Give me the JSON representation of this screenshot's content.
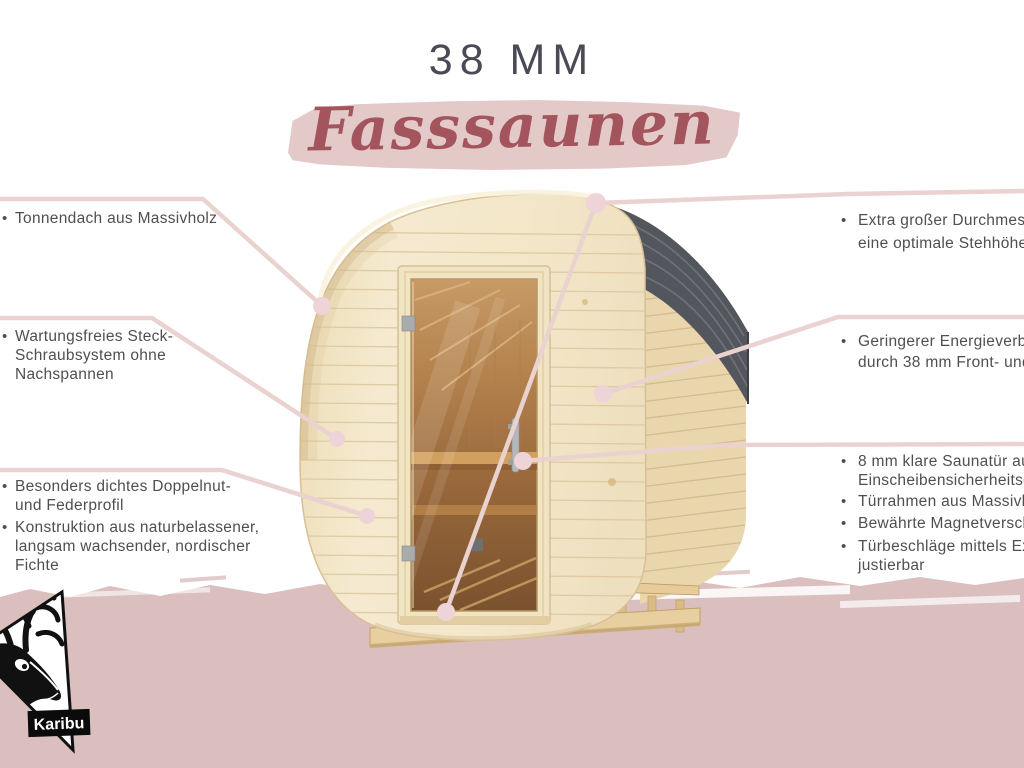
{
  "glyphs": {
    "bullet": "•"
  },
  "title": {
    "size_label": "38 MM",
    "product_label": "Fasssaunen"
  },
  "features_left": [
    {
      "lines": [
        "Tonnendach aus Massivholz"
      ]
    },
    {
      "lines": [
        "Wartungsfreies Steck-",
        "Schraubsystem ohne",
        "Nachspannen"
      ]
    },
    {
      "lines": [
        "Besonders dichtes Doppelnut-",
        "und Federprofil"
      ]
    },
    {
      "lines": [
        "Konstruktion aus naturbelassener,",
        "langsam wachsender, nordischer",
        "Fichte"
      ]
    }
  ],
  "features_right": [
    {
      "lines": [
        "Extra großer Durchmesser für",
        "eine optimale Stehhöhe"
      ]
    },
    {
      "lines": [
        "Geringerer Energieverbrauch",
        "durch 38 mm Front- und Rückwand"
      ]
    },
    {
      "lines": [
        "8 mm klare Saunatür aus",
        "Einscheibensicherheitsglas"
      ]
    },
    {
      "lines": [
        "Türrahmen aus Massivholz"
      ]
    },
    {
      "lines": [
        "Bewährte Magnetverschlusstechnik"
      ]
    },
    {
      "lines": [
        "Türbeschläge mittels Exzenter",
        "justierbar"
      ]
    }
  ],
  "logo": {
    "brand": "Karibu"
  },
  "colors": {
    "band_pink": "#dabfbe",
    "brush_pink": "#e3cac9",
    "script_red": "#a4545c",
    "title_gray": "#4a4a56",
    "text_gray": "#4f4f4f",
    "callout_line": "#e9d2d0",
    "callout_dot": "#eed3d9",
    "roof_gray": "#54565e",
    "wood_light": "#f3e6c8"
  }
}
